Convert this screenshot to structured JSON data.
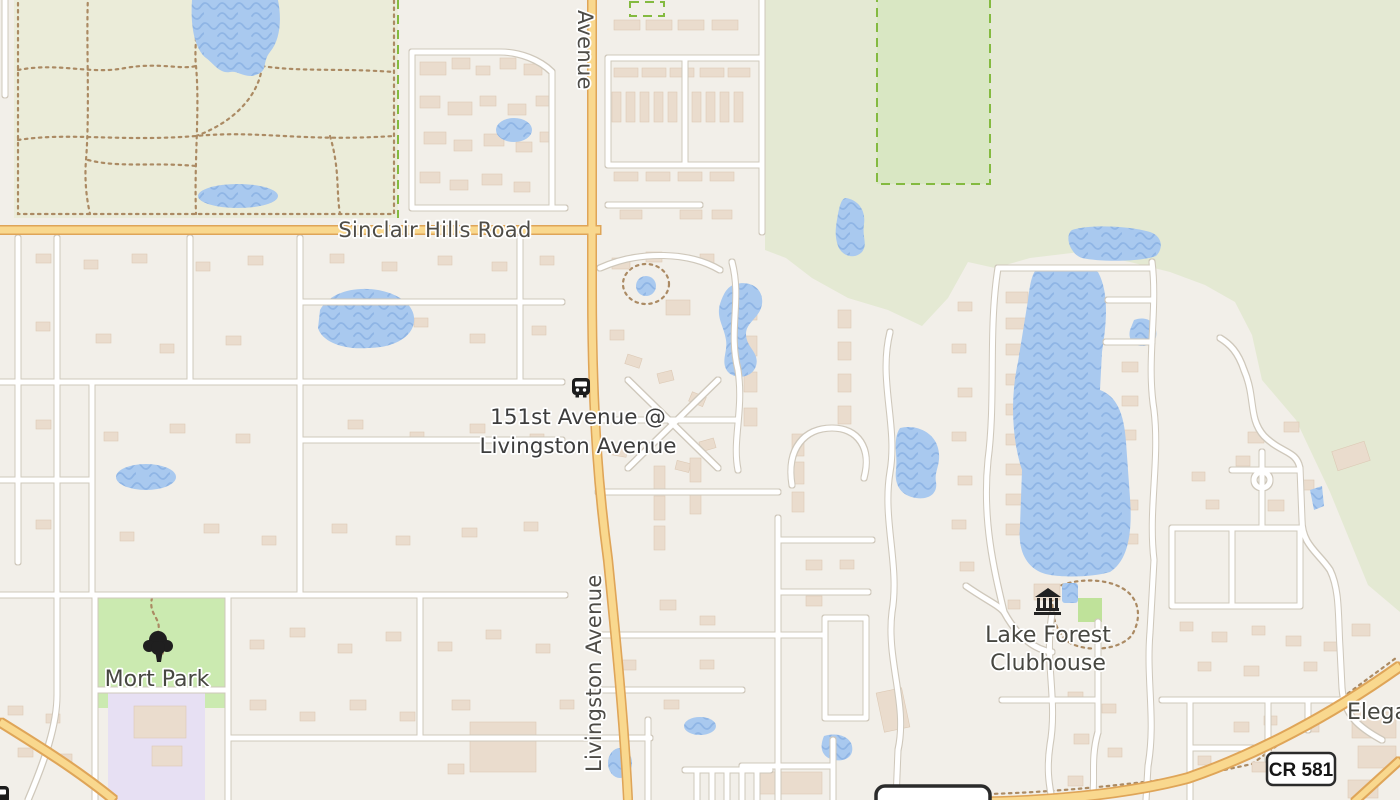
{
  "map": {
    "labels": {
      "road_sinclair": "Sinclair Hills Road",
      "road_avenue_top": "Avenue",
      "road_livingston": "Livingston Avenue",
      "stop_line1": "151st  Avenue @",
      "stop_line2": "Livingston Avenue",
      "park": "Mort Park",
      "clubhouse_line1": "Lake Forest",
      "clubhouse_line2": "Clubhouse",
      "edge_truncated": "Elega",
      "shield_primary": "CR 581",
      "shield_secondary": "CR 581"
    },
    "icons": {
      "transit_stop": "bus-stop-icon",
      "transit_stop_partial": "bus-stop-icon",
      "park_tree": "tree-icon",
      "clubhouse": "classical-building-icon"
    },
    "colors": {
      "background": "#f2efe9",
      "greenspace": "#e4e9d3",
      "park_greenspace": "#ebecd9",
      "park_green": "#cbeab0",
      "conservation_fill": "#d9e7c3",
      "conservation_border": "#84ba40",
      "water": "#a9c9ef",
      "water_wave": "#8fb5e5",
      "road_primary_fill": "#f9d88e",
      "road_primary_casing": "#dfa558",
      "road_minor_fill": "#ffffff",
      "road_minor_casing": "#cfc8bb",
      "building": "#eadccd",
      "school_area": "#e7e0f3",
      "trail": "#ab8a63",
      "label_text": "#4e4c47",
      "shield_border": "#2b2b2b"
    }
  }
}
